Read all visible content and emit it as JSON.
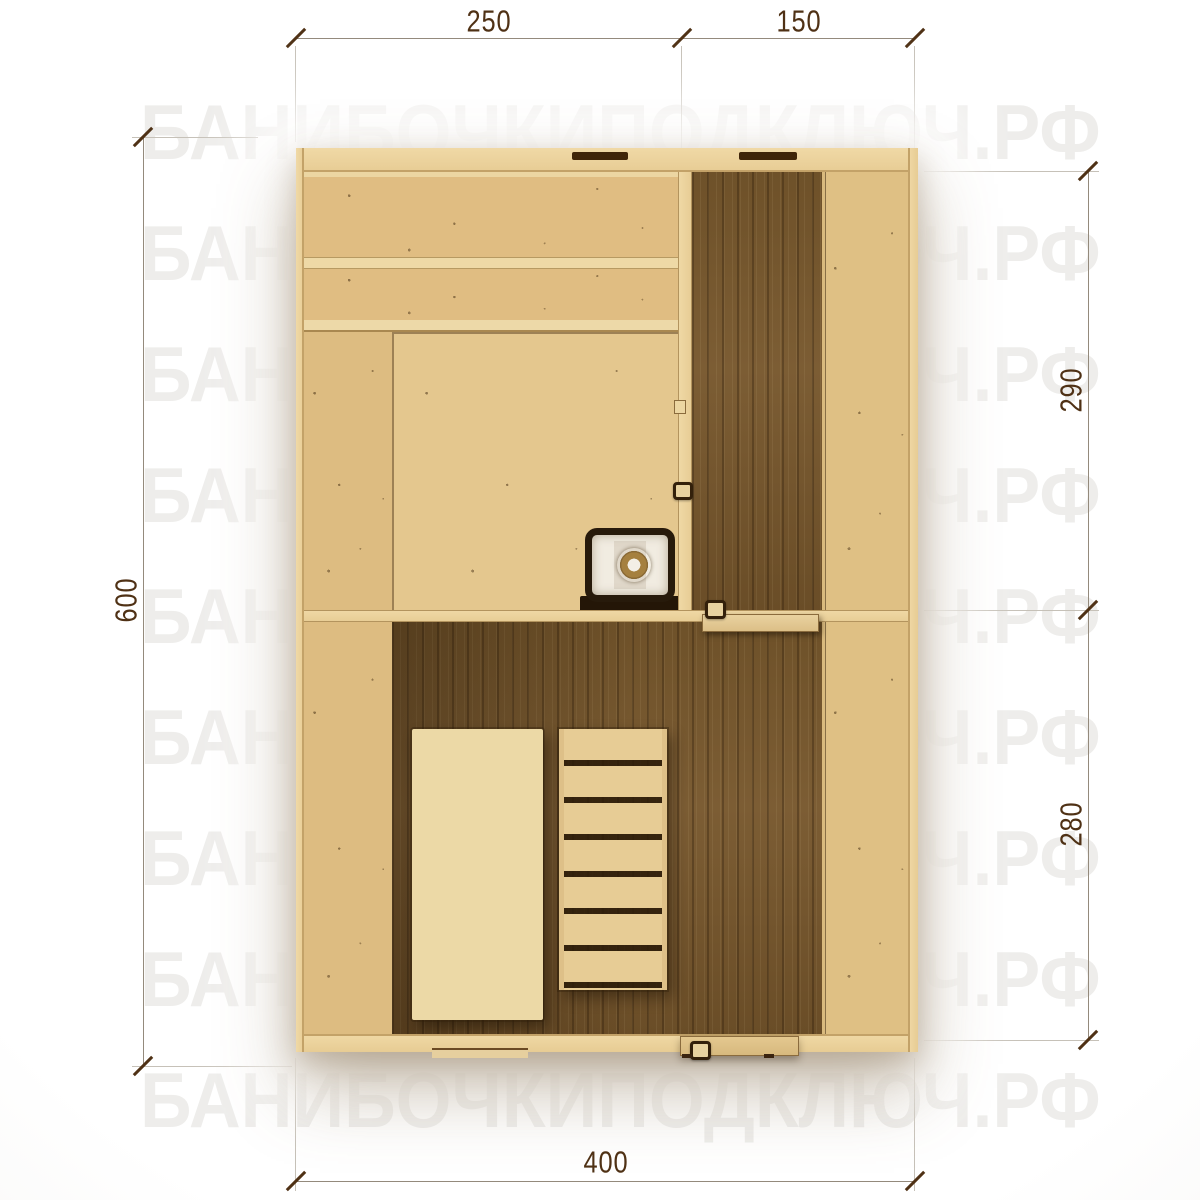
{
  "watermark": {
    "text": "БАНИБОЧКИПОДКЛЮЧ.РФ"
  },
  "dimensions": {
    "top_left_cm": "250",
    "top_right_cm": "150",
    "left_total_cm": "600",
    "right_upper_cm": "290",
    "right_lower_cm": "280",
    "bottom_total_cm": "400"
  },
  "colors": {
    "dimension_text": "#4f3115",
    "light_wood": "#e2c187",
    "dark_wood": "#74552e",
    "stove_body": "#f1ece1",
    "watermark_tint": "#e9e7e4"
  }
}
